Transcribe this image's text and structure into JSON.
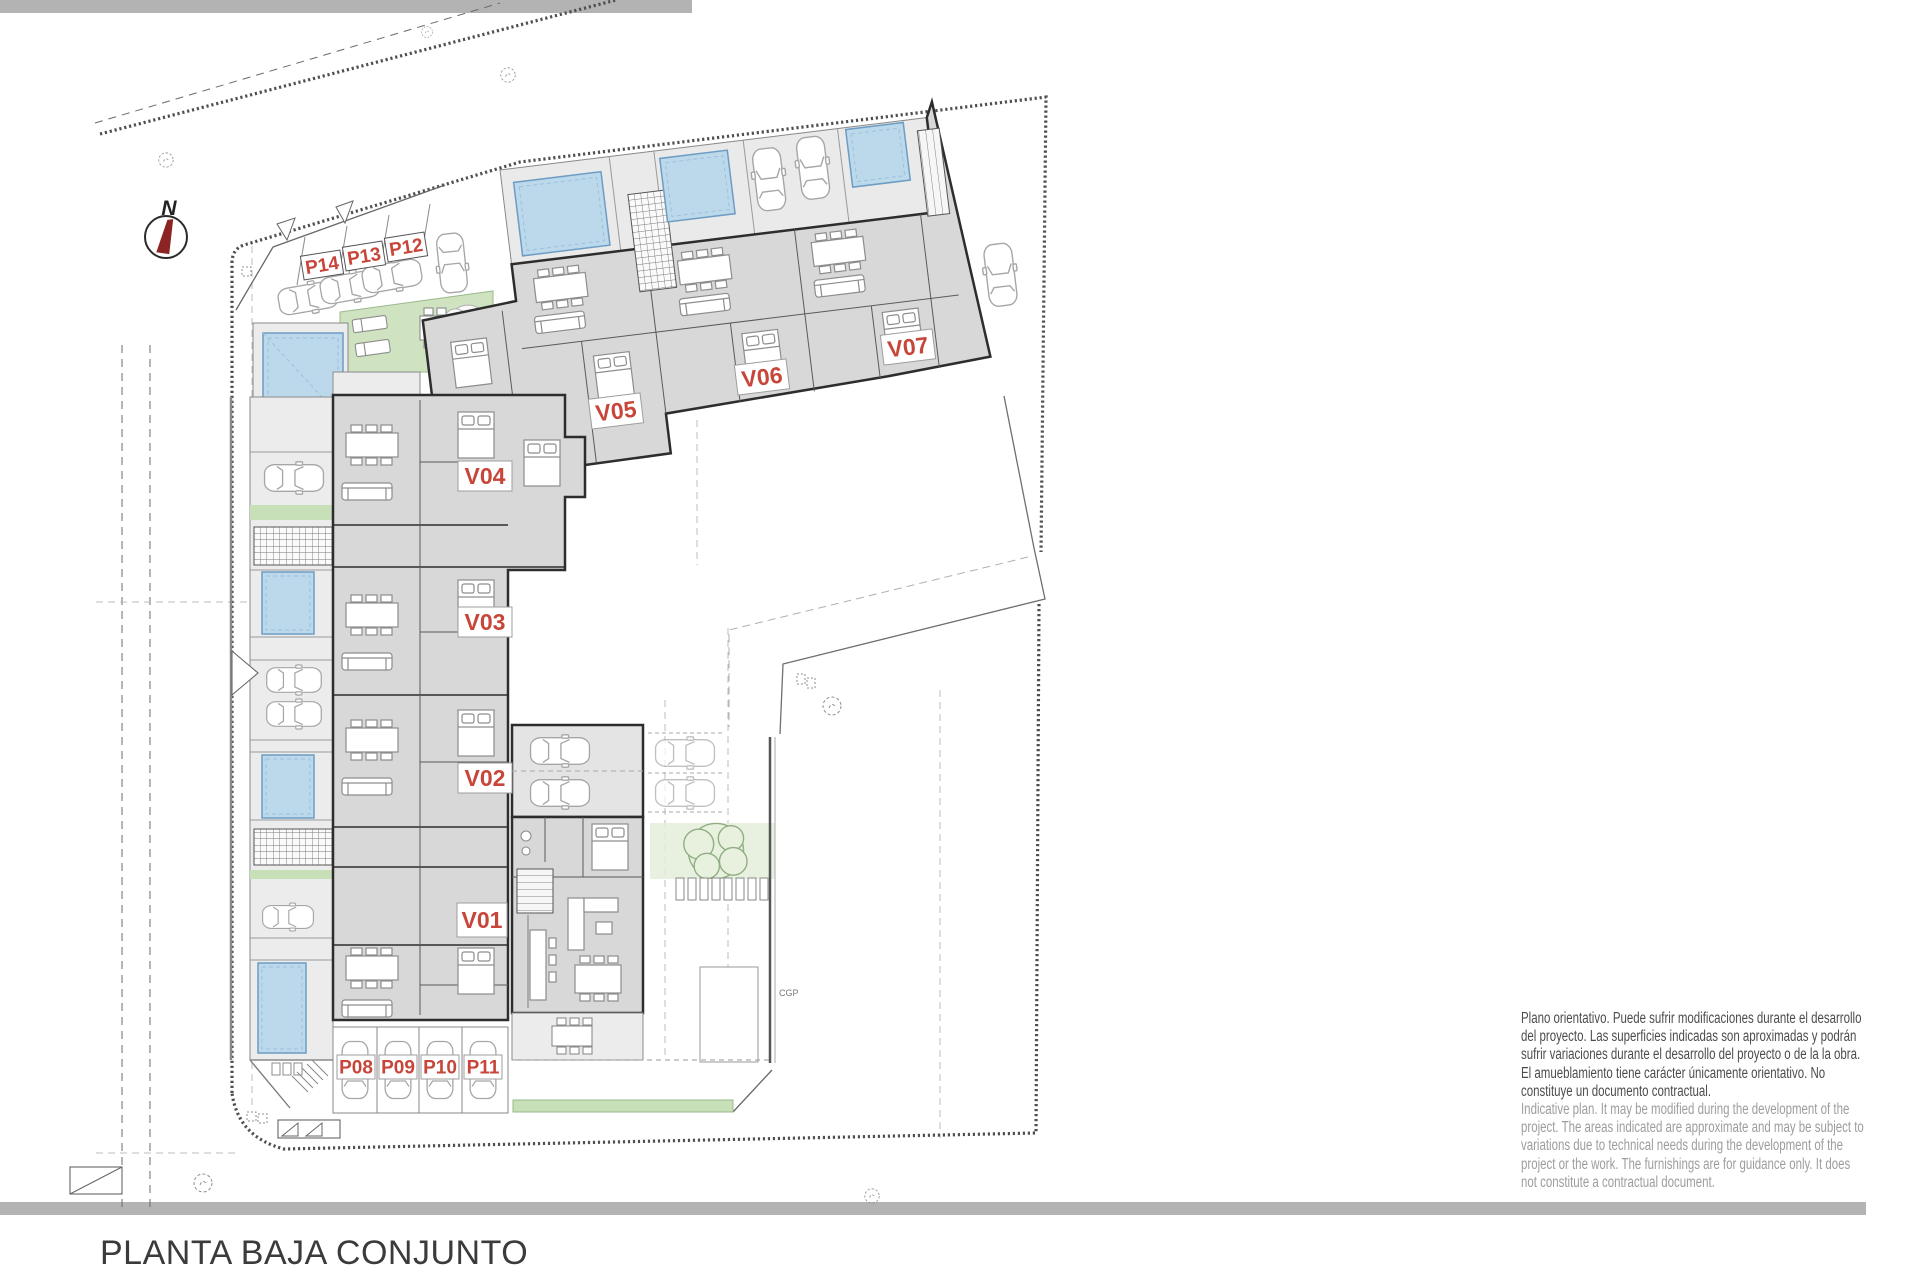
{
  "page": {
    "title": "PLANTA BAJA CONJUNTO"
  },
  "compass": {
    "north_label": "N"
  },
  "unit_labels": {
    "v01": "V01",
    "v02": "V02",
    "v03": "V03",
    "v04": "V04",
    "v05": "V05",
    "v06": "V06",
    "v07": "V07"
  },
  "parking_labels": {
    "p08": "P08",
    "p09": "P09",
    "p10": "P10",
    "p11": "P11",
    "p12": "P12",
    "p13": "P13",
    "p14": "P14"
  },
  "annotations": {
    "cgp": "CGP"
  },
  "disclaimer": {
    "es_lines": [
      "Plano orientativo. Puede sufrir modificaciones durante el desarrollo",
      "del proyecto. Las superficies indicadas son aproximadas y podrán",
      "sufrir variaciones durante el desarrollo del proyecto o de la la obra.",
      "El amueblamiento tiene carácter únicamente orientativo. No",
      "constituye un documento contractual."
    ],
    "en_lines": [
      "Indicative plan. It may be modified during the development of the",
      "project. The areas indicated are approximate and may be subject to",
      "variations due to technical needs during the development of the",
      "project or the work. The furnishings are for guidance only. It does",
      "not constitute a contractual document."
    ]
  },
  "colors": {
    "label_red": "#c8453a",
    "pool_fill": "#bcd9ec",
    "pool_edge": "#6d9cc3",
    "building_fill": "#d8d8d8",
    "terrace_fill": "#ececec",
    "wall": "#2d2d2d",
    "lawn_green": "#cfe3c0",
    "bar_gray": "#b3b3b3"
  }
}
